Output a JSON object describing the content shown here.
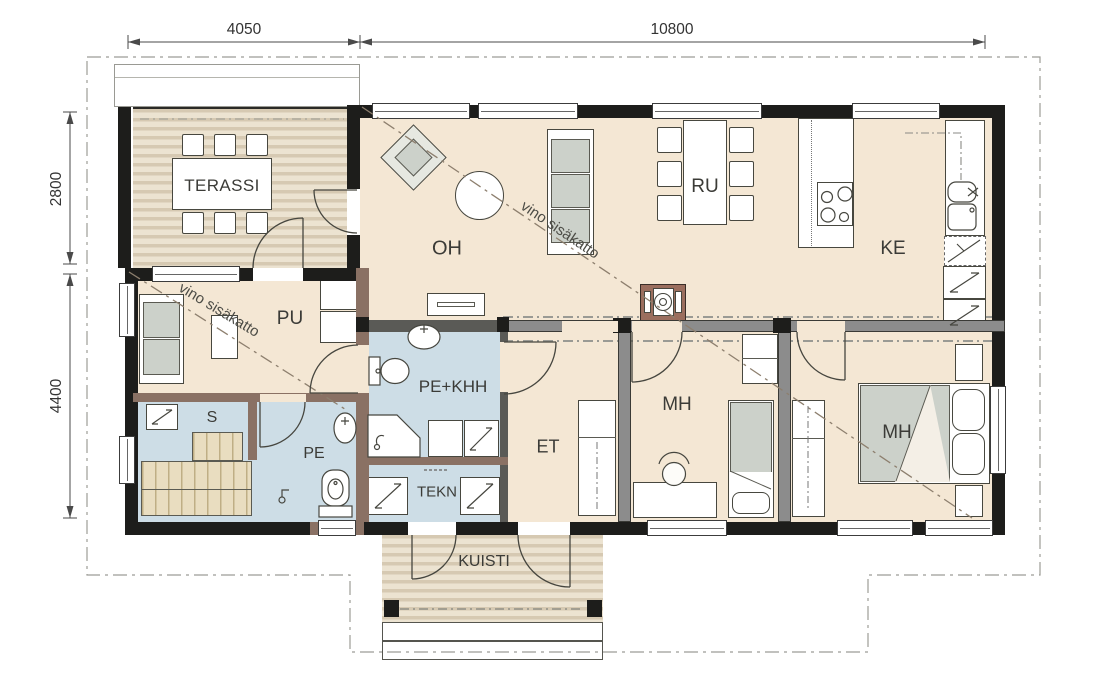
{
  "dimensions": {
    "top": [
      {
        "label": "4050"
      },
      {
        "label": "10800"
      }
    ],
    "left": [
      {
        "label": "2800"
      },
      {
        "label": "4400"
      }
    ]
  },
  "rooms": {
    "terassi": {
      "label": "TERASSI"
    },
    "oh": {
      "label": "OH"
    },
    "ru": {
      "label": "RU"
    },
    "ke": {
      "label": "KE"
    },
    "pu": {
      "label": "PU"
    },
    "pe_khh": {
      "label": "PE+KHH"
    },
    "pe": {
      "label": "PE"
    },
    "s": {
      "label": "S"
    },
    "tekn": {
      "label": "TEKN"
    },
    "et": {
      "label": "ET"
    },
    "mh_mid": {
      "label": "MH"
    },
    "mh_right": {
      "label": "MH"
    },
    "kuisti": {
      "label": "KUISTI"
    }
  },
  "annotations": {
    "sloped_ceiling_oh": "vino sisäkatto",
    "sloped_ceiling_pu": "vino sisäkatto"
  },
  "colors": {
    "floor": "#f4e7d4",
    "wet_floor": "#cddde6",
    "deck_stripe": "#d6c9b2",
    "wall": "#1d1d1b",
    "wet_wall": "#8a7164",
    "interior_wall": "#8c8c8c",
    "furniture": "#ccd1ca",
    "fireplace": "#9b6e5e"
  }
}
